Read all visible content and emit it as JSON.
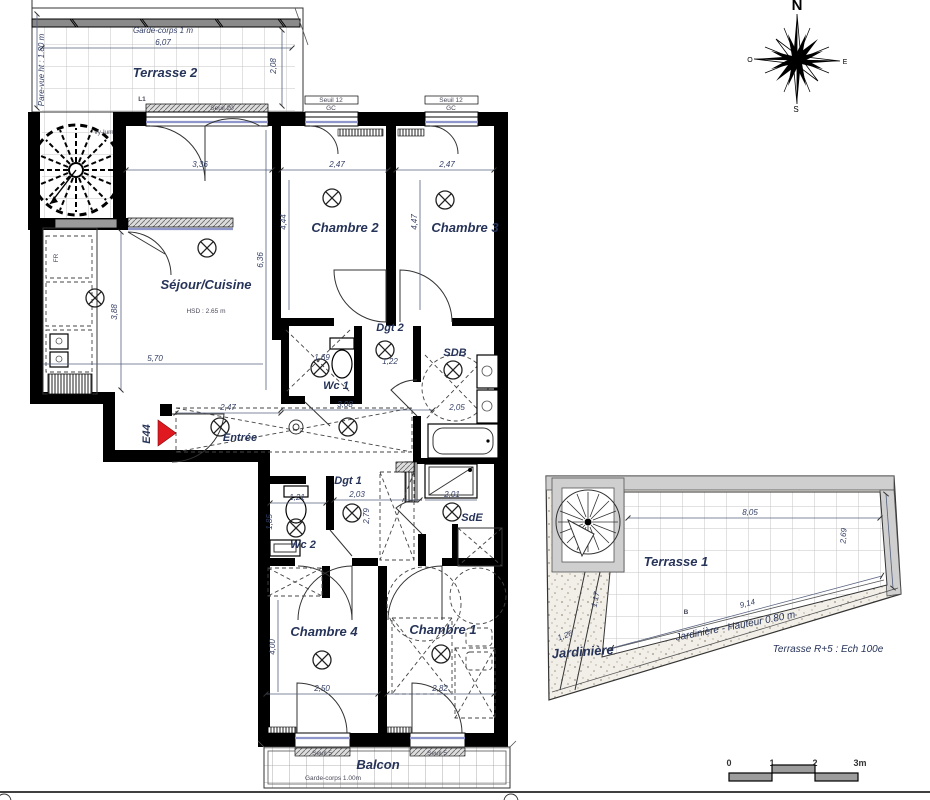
{
  "colors": {
    "wall": "#000000",
    "dim_text": "#333f66",
    "room_text": "#273459",
    "red_marker": "#e0181f",
    "glazing": "#8f96cc",
    "terrace_wall": "#cfcfcf"
  },
  "rooms": {
    "terrasse2": "Terrasse 2",
    "sejour": "Séjour/Cuisine",
    "sejour_hsd": "HSD : 2.65 m",
    "chambre2": "Chambre 2",
    "chambre3": "Chambre 3",
    "chambre4": "Chambre 4",
    "chambre1": "Chambre 1",
    "dgt2": "Dgt 2",
    "dgt1": "Dgt 1",
    "wc1": "Wc 1",
    "wc2": "Wc 2",
    "sdb": "SDB",
    "sde": "SdE",
    "entree": "Entrée",
    "balcon": "Balcon",
    "terrasse1": "Terrasse 1",
    "jardiniere": "Jardinière"
  },
  "annotations": {
    "garde_corps_1m": "Garde-corps 1 m",
    "pare_vue": "Pare-vue ht : 1.80 m",
    "l1": "L1",
    "vy_lum": "vy-lum",
    "seuil_20": "Seuil 20",
    "seuil_12_a": "Seuil 12",
    "seuil_12_b": "Seuil 12",
    "gc_a": "GC",
    "gc_b": "GC",
    "seuil_5_a": "Seuil 5",
    "seuil_5_b": "Seuil 5",
    "garde_corps_100": "Garde-corps 1.00m",
    "jardiniere_hauteur": "Jardinière - Hauteur 0.80 m",
    "terrasse_r5": "Terrasse R+5 : Ech 100e",
    "e44": "E44",
    "fr": "FR",
    "b_marker": "B"
  },
  "dims": {
    "d607": "6,07",
    "d208": "2,08",
    "d336": "3,36",
    "d247_c2": "2,47",
    "d247_c3": "2,47",
    "d444": "4,44",
    "d447": "4,47",
    "d636": "6,36",
    "d388": "3,88",
    "d570": "5,70",
    "d247_ent": "2,47",
    "d169": "1,69",
    "d122": "1,22",
    "d308": "3,08",
    "d205": "2,05",
    "d201": "2,01",
    "d203": "2,03",
    "d279": "2,79",
    "d121": "1,21",
    "d185": "1,85",
    "d400": "4,00",
    "d250": "2,50",
    "d282": "2,82",
    "d533": "5,33",
    "d805": "8,05",
    "d914": "9,14",
    "d269": "2,69",
    "d126": "1,26",
    "d117": "1,17"
  },
  "compass": {
    "n": "N",
    "o": "O",
    "e": "E",
    "s": "S"
  },
  "scale_bar": {
    "t0": "0",
    "t1": "1",
    "t2": "2",
    "t3": "3m"
  }
}
